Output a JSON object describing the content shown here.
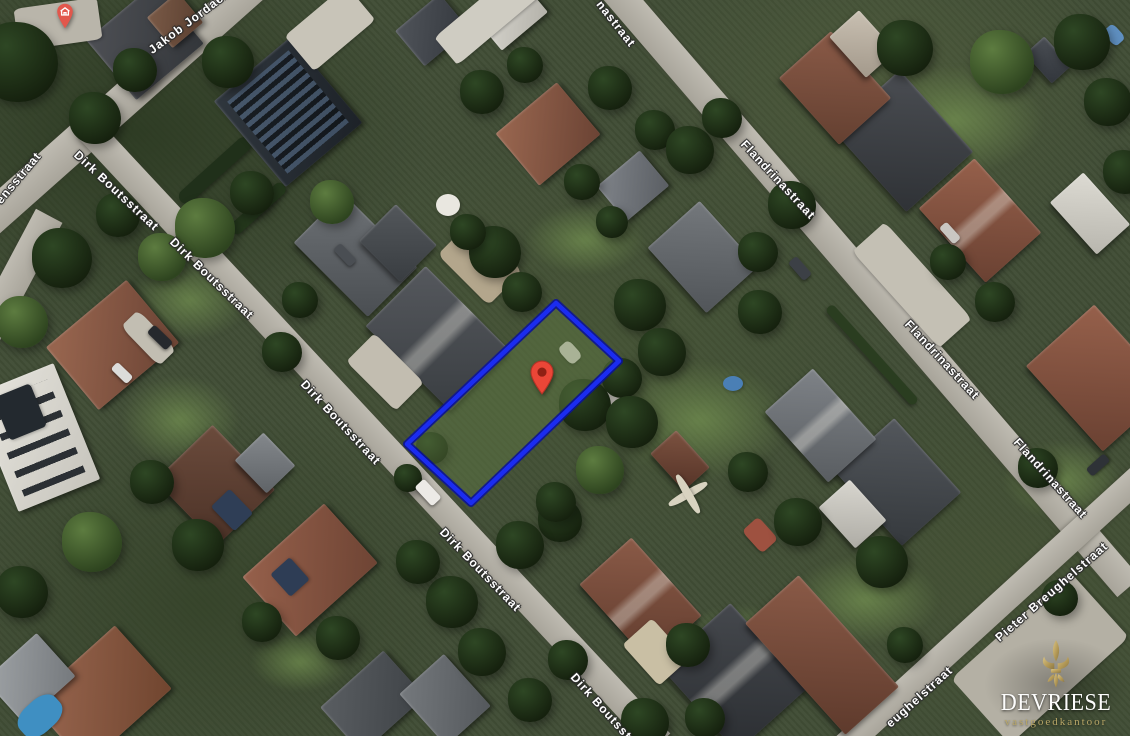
{
  "meta": {
    "view": "aerial-satellite",
    "width": 1130,
    "height": 736
  },
  "branding": {
    "company": "DEVRIESE",
    "tagline": "vastgoedkantoor",
    "logo_icon": "fleur-de-lis-icon",
    "gold_light": "#d9c384",
    "gold_dark": "#8d7843",
    "text_color": "#fdfdfc"
  },
  "property": {
    "polygon_points": "556,303 619,361 471,503 407,444",
    "outline_color": "#1b2cf0",
    "outline_halo": "#0a119b",
    "fill_color": "rgba(97,124,70,0.5)",
    "marker": {
      "tip_x": 542,
      "tip_y": 394,
      "fill": "#ea4637",
      "stroke": "#b33226",
      "inner_dot": "#8f2014"
    }
  },
  "poi_marker": {
    "tip_x": 65,
    "tip_y": 28,
    "fill": "#e2574c",
    "icon": "house-icon",
    "icon_color": "#ffffff"
  },
  "street_labels": [
    {
      "name": "jakob-jordaensstraat",
      "text": "Jakob Jordaensstraat",
      "x": 150,
      "y": 52,
      "rot": -37
    },
    {
      "name": "ensstraat-partial",
      "text": "ensstraat",
      "x": -2,
      "y": 203,
      "rot": -50
    },
    {
      "name": "dirk-boutsstraat-1",
      "text": "Dirk Boutsstraat",
      "x": 76,
      "y": 154,
      "rot": 43
    },
    {
      "name": "dirk-boutsstraat-2",
      "text": "Dirk Boutsstraat",
      "x": 172,
      "y": 241,
      "rot": 44
    },
    {
      "name": "dirk-boutsstraat-3",
      "text": "Dirk Boutsstraat",
      "x": 303,
      "y": 383,
      "rot": 47
    },
    {
      "name": "dirk-boutsstraat-4",
      "text": "Dirk Boutsstraat",
      "x": 442,
      "y": 531,
      "rot": 46
    },
    {
      "name": "dirk-boutsstraat-5",
      "text": "Dirk Boutsstraat",
      "x": 573,
      "y": 676,
      "rot": 48
    },
    {
      "name": "flandrinastraat-top-partial",
      "text": "nastraat",
      "x": 599,
      "y": 3,
      "rot": 52
    },
    {
      "name": "flandrinastraat-2",
      "text": "Flandrinastraat",
      "x": 743,
      "y": 143,
      "rot": 47
    },
    {
      "name": "flandrinastraat-3",
      "text": "Flandrinastraat",
      "x": 907,
      "y": 323,
      "rot": 47
    },
    {
      "name": "flandrinastraat-4",
      "text": "Flandrinastraat",
      "x": 1016,
      "y": 441,
      "rot": 48
    },
    {
      "name": "pieter-breughelstraat",
      "text": "Pieter Breughelstraat",
      "x": 997,
      "y": 640,
      "rot": -41
    },
    {
      "name": "eughelstraat-partial",
      "text": "eughelstraat",
      "x": 888,
      "y": 726,
      "rot": -42
    }
  ],
  "scene": {
    "roads_format": "[cx,cy,length,width,rotDeg]",
    "roads": [
      [
        124,
        100,
        385,
        34,
        -41.6
      ],
      [
        14,
        282,
        150,
        30,
        -62
      ],
      [
        374,
        435,
        840,
        27,
        47
      ],
      [
        869,
        286,
        795,
        30,
        49.3
      ],
      [
        990,
        613,
        401,
        26,
        -42.4
      ]
    ],
    "lawns_format": "[cx,cy,w,h]",
    "lawns": [
      [
        190,
        300,
        120,
        80
      ],
      [
        700,
        420,
        180,
        120
      ],
      [
        955,
        120,
        180,
        110
      ],
      [
        1062,
        480,
        120,
        80
      ],
      [
        585,
        240,
        120,
        70
      ],
      [
        865,
        600,
        150,
        90
      ],
      [
        300,
        662,
        100,
        60
      ],
      [
        180,
        420,
        120,
        90
      ],
      [
        740,
        640,
        120,
        70
      ]
    ],
    "hedges_format": "[cx,cy,w,h,rotDeg,color]",
    "hedges": [
      [
        215,
        170,
        92,
        15,
        -42,
        "#20301a"
      ],
      [
        258,
        208,
        70,
        13,
        -42,
        "#24371c"
      ],
      [
        872,
        355,
        130,
        10,
        48,
        "#2a3d20"
      ]
    ],
    "houses_format": "[cx,cy,w,h,rotDeg,color1,color2,style]",
    "houses": [
      [
        145,
        42,
        88,
        78,
        -40,
        "#4e5055",
        "#33363a",
        ""
      ],
      [
        175,
        20,
        40,
        40,
        -40,
        "#7a5a47",
        "#5a3f30",
        ""
      ],
      [
        288,
        112,
        100,
        112,
        -40,
        "#30373e",
        "#1d2228",
        "solar"
      ],
      [
        548,
        134,
        80,
        68,
        -40,
        "#9a6750",
        "#6b4334",
        ""
      ],
      [
        633,
        186,
        56,
        46,
        -40,
        "#80848a",
        "#5a5e63",
        ""
      ],
      [
        703,
        257,
        88,
        70,
        48,
        "#74787c",
        "#515559",
        ""
      ],
      [
        355,
        255,
        105,
        70,
        45,
        "#6e7276",
        "#4a4e52",
        ""
      ],
      [
        398,
        243,
        58,
        52,
        45,
        "#53575b",
        "#393d41",
        ""
      ],
      [
        438,
        338,
        120,
        85,
        45,
        "#55585d",
        "#3a3e42",
        "gable"
      ],
      [
        112,
        345,
        105,
        82,
        -40,
        "#9a6750",
        "#6b4334",
        ""
      ],
      [
        36,
        437,
        88,
        125,
        -22,
        "#e7e5de",
        "#c6c4bc",
        "panels"
      ],
      [
        215,
        485,
        90,
        80,
        46,
        "#6b4b3c",
        "#4c3227",
        ""
      ],
      [
        265,
        463,
        46,
        40,
        46,
        "#84888c",
        "#5f6367",
        ""
      ],
      [
        310,
        570,
        110,
        80,
        -42,
        "#96604b",
        "#6e4434",
        ""
      ],
      [
        100,
        695,
        115,
        85,
        -42,
        "#9a6750",
        "#70452f",
        ""
      ],
      [
        30,
        678,
        70,
        58,
        -42,
        "#9fa3a6",
        "#75797d",
        ""
      ],
      [
        372,
        702,
        85,
        62,
        -42,
        "#5a5e62",
        "#3e4246",
        ""
      ],
      [
        445,
        700,
        60,
        70,
        -42,
        "#75797d",
        "#54585c",
        ""
      ],
      [
        640,
        600,
        105,
        70,
        48,
        "#8a5a47",
        "#613c2e",
        "gable"
      ],
      [
        733,
        677,
        115,
        95,
        48,
        "#45484d",
        "#2b2e32",
        "gable"
      ],
      [
        822,
        655,
        150,
        72,
        48,
        "#8a5a47",
        "#5e3a2c",
        ""
      ],
      [
        903,
        141,
        110,
        90,
        48,
        "#4a4d52",
        "#2f3236",
        ""
      ],
      [
        980,
        220,
        100,
        75,
        48,
        "#96604b",
        "#6a4132",
        "gable"
      ],
      [
        1090,
        213,
        70,
        45,
        48,
        "#dddbd3",
        "#b8b6ae",
        ""
      ],
      [
        835,
        88,
        90,
        70,
        48,
        "#8a5a47",
        "#644031",
        ""
      ],
      [
        862,
        44,
        55,
        40,
        48,
        "#c9c0b2",
        "#a3998b",
        ""
      ],
      [
        1098,
        378,
        115,
        92,
        48,
        "#96604b",
        "#6a4132",
        ""
      ],
      [
        898,
        482,
        100,
        80,
        48,
        "#53575c",
        "#35393d",
        ""
      ],
      [
        852,
        514,
        55,
        42,
        48,
        "#d8d6cf",
        "#aeaca5",
        ""
      ],
      [
        820,
        425,
        95,
        65,
        48,
        "#7e8287",
        "#595d61",
        "gable"
      ],
      [
        680,
        460,
        50,
        35,
        48,
        "#7c5240",
        "#553327",
        ""
      ],
      [
        512,
        16,
        60,
        40,
        -40,
        "#d9d7d0",
        "#b4b2aa",
        ""
      ],
      [
        432,
        30,
        58,
        46,
        -40,
        "#50545a",
        "#34383e",
        ""
      ],
      [
        1048,
        60,
        40,
        26,
        48,
        "#4a4e54",
        "#32363c",
        ""
      ]
    ],
    "patches_format": "[cx,cy,w,h,rotDeg,color,borderRadiusPct]",
    "patches": [
      [
        330,
        28,
        80,
        46,
        -40,
        "#c8c4b8",
        8
      ],
      [
        488,
        16,
        110,
        36,
        -40,
        "#cfccc2",
        8
      ],
      [
        58,
        24,
        84,
        42,
        -8,
        "#b9b5aa",
        10
      ],
      [
        385,
        372,
        70,
        40,
        45,
        "#c2bdb0",
        10
      ],
      [
        480,
        263,
        72,
        48,
        45,
        "#b3a68c",
        12
      ],
      [
        912,
        285,
        130,
        44,
        48,
        "#c4c0b4",
        8
      ],
      [
        1040,
        658,
        160,
        88,
        -42,
        "#b4b0a4",
        6
      ],
      [
        655,
        652,
        55,
        40,
        48,
        "#c9bfa4",
        10
      ],
      [
        148,
        338,
        55,
        24,
        46,
        "#c2beb2",
        20
      ],
      [
        20,
        412,
        40,
        46,
        -22,
        "#23292f",
        10
      ],
      [
        232,
        510,
        34,
        26,
        46,
        "#2f3e56",
        10
      ],
      [
        290,
        577,
        26,
        30,
        -42,
        "#2e3d55",
        10
      ],
      [
        448,
        205,
        24,
        22,
        0,
        "#e9e7e0",
        50
      ],
      [
        570,
        352,
        22,
        15,
        48,
        "#dedbd2",
        30
      ],
      [
        613,
        396,
        30,
        14,
        -42,
        "#d8d5cc",
        30
      ],
      [
        733,
        383,
        20,
        15,
        0,
        "#4a7fb5",
        50
      ],
      [
        1114,
        35,
        20,
        14,
        48,
        "#5f8fc0",
        30
      ],
      [
        40,
        716,
        48,
        32,
        -42,
        "#3f8fc2",
        40
      ],
      [
        688,
        494,
        44,
        8,
        -30,
        "#d8d3c0",
        40
      ],
      [
        688,
        494,
        8,
        44,
        -30,
        "#d8d3c0",
        40
      ],
      [
        760,
        535,
        30,
        22,
        48,
        "#9e5140",
        20
      ]
    ],
    "trees_format": "[cx,cy,radius,isLight]",
    "trees": [
      [
        18,
        62,
        40,
        0
      ],
      [
        95,
        118,
        26,
        0
      ],
      [
        135,
        70,
        22,
        0
      ],
      [
        228,
        62,
        26,
        0
      ],
      [
        118,
        215,
        22,
        0
      ],
      [
        205,
        228,
        30,
        1
      ],
      [
        252,
        193,
        22,
        0
      ],
      [
        162,
        257,
        24,
        1
      ],
      [
        62,
        258,
        30,
        0
      ],
      [
        22,
        322,
        26,
        1
      ],
      [
        332,
        202,
        22,
        1
      ],
      [
        300,
        300,
        18,
        0
      ],
      [
        282,
        352,
        20,
        0
      ],
      [
        482,
        92,
        22,
        0
      ],
      [
        525,
        65,
        18,
        0
      ],
      [
        495,
        252,
        26,
        0
      ],
      [
        522,
        292,
        20,
        0
      ],
      [
        468,
        232,
        18,
        0
      ],
      [
        610,
        88,
        22,
        0
      ],
      [
        655,
        130,
        20,
        0
      ],
      [
        690,
        150,
        24,
        0
      ],
      [
        722,
        118,
        20,
        0
      ],
      [
        582,
        182,
        18,
        0
      ],
      [
        612,
        222,
        16,
        0
      ],
      [
        585,
        405,
        26,
        0
      ],
      [
        622,
        378,
        20,
        0
      ],
      [
        432,
        448,
        16,
        0
      ],
      [
        408,
        478,
        14,
        0
      ],
      [
        640,
        305,
        26,
        0
      ],
      [
        662,
        352,
        24,
        0
      ],
      [
        632,
        422,
        26,
        0
      ],
      [
        600,
        470,
        24,
        1
      ],
      [
        560,
        520,
        22,
        0
      ],
      [
        760,
        312,
        22,
        0
      ],
      [
        792,
        205,
        24,
        0
      ],
      [
        758,
        252,
        20,
        0
      ],
      [
        905,
        48,
        28,
        0
      ],
      [
        1002,
        62,
        32,
        1
      ],
      [
        1082,
        42,
        28,
        0
      ],
      [
        1108,
        102,
        24,
        0
      ],
      [
        1125,
        172,
        22,
        0
      ],
      [
        948,
        262,
        18,
        0
      ],
      [
        995,
        302,
        20,
        0
      ],
      [
        1038,
        468,
        20,
        0
      ],
      [
        882,
        562,
        26,
        0
      ],
      [
        798,
        522,
        24,
        0
      ],
      [
        748,
        472,
        20,
        0
      ],
      [
        452,
        602,
        26,
        0
      ],
      [
        482,
        652,
        24,
        0
      ],
      [
        418,
        562,
        22,
        0
      ],
      [
        520,
        545,
        24,
        0
      ],
      [
        556,
        502,
        20,
        0
      ],
      [
        92,
        542,
        30,
        1
      ],
      [
        22,
        592,
        26,
        0
      ],
      [
        152,
        482,
        22,
        0
      ],
      [
        198,
        545,
        26,
        0
      ],
      [
        262,
        622,
        20,
        0
      ],
      [
        338,
        638,
        22,
        0
      ],
      [
        688,
        645,
        22,
        0
      ],
      [
        645,
        722,
        24,
        0
      ],
      [
        705,
        718,
        20,
        0
      ],
      [
        568,
        660,
        20,
        0
      ],
      [
        530,
        700,
        22,
        0
      ],
      [
        905,
        645,
        18,
        0
      ],
      [
        1060,
        598,
        18,
        0
      ]
    ],
    "cars_format": "[cx,cy,w,h,rotDeg,color]",
    "cars": [
      [
        160,
        337,
        26,
        11,
        44,
        "#26292d"
      ],
      [
        122,
        373,
        22,
        10,
        44,
        "#dcdcda"
      ],
      [
        428,
        492,
        26,
        13,
        47,
        "#eceae6"
      ],
      [
        800,
        268,
        24,
        11,
        49,
        "#3c4046"
      ],
      [
        950,
        233,
        22,
        10,
        48,
        "#c9c7c2"
      ],
      [
        1098,
        465,
        24,
        10,
        -42,
        "#2e3237"
      ],
      [
        345,
        255,
        24,
        10,
        46,
        "#4a4e53"
      ]
    ]
  }
}
